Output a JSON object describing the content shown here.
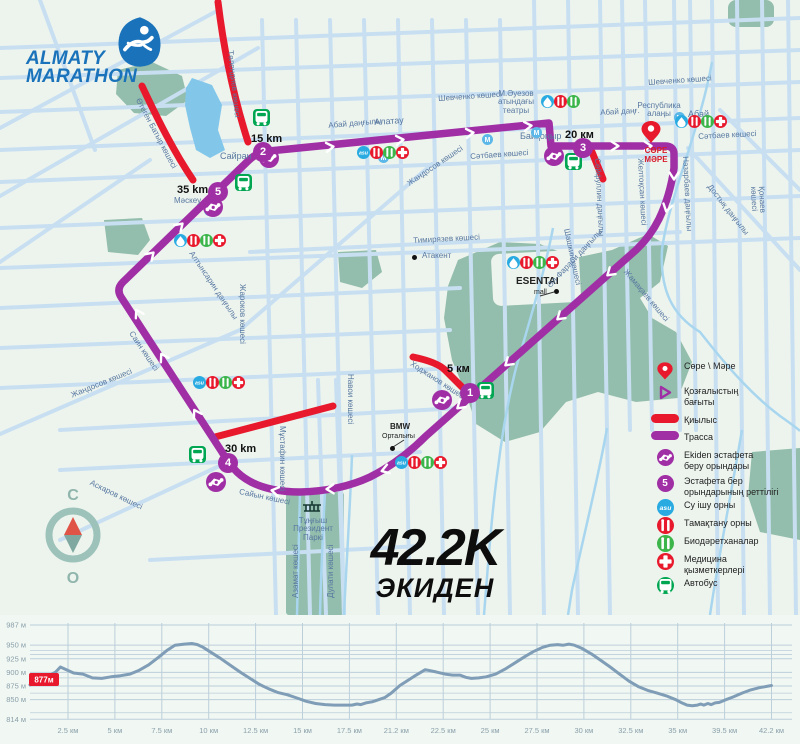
{
  "logo": {
    "line1": "ALMATY",
    "line2": "MARATHON"
  },
  "race_title": {
    "big": "42.2K",
    "sub": "ЭКИДЕН"
  },
  "compass": {
    "north": "С",
    "south": "О"
  },
  "finish": {
    "label": "СӨРЕ\nМӘРЕ"
  },
  "colors": {
    "route": "#a02fa5",
    "crossing": "#e8192c",
    "street": "#c8dff2",
    "park": "#93bdac",
    "water": "#82c7ea",
    "river": "#a9d6ef",
    "bus_green": "#00a651",
    "bio_green": "#3cb54a",
    "asu_blue": "#29abe2",
    "metro_blue": "#5bb7e8",
    "logo_blue": "#1a73ba",
    "chart_line": "#7f9db6",
    "chart_grid": "#bccfdb",
    "badge_red": "#e8192c"
  },
  "markers": [
    {
      "num": "1",
      "x": 470,
      "y": 393,
      "label": "5 км",
      "lx": 447,
      "ly": 363
    },
    {
      "num": "2",
      "x": 263,
      "y": 152,
      "label": "15 km",
      "lx": 251,
      "ly": 133
    },
    {
      "num": "3",
      "x": 583,
      "y": 148,
      "label": "20 км",
      "lx": 565,
      "ly": 129
    },
    {
      "num": "4",
      "x": 228,
      "y": 463,
      "label": "30 km",
      "lx": 225,
      "ly": 443
    },
    {
      "num": "5",
      "x": 218,
      "y": 192,
      "label": "35 km",
      "lx": 177,
      "ly": 184
    }
  ],
  "map_labels": [
    {
      "t": "Шевченко көшесі",
      "x": 438,
      "y": 95,
      "r": -4
    },
    {
      "t": "Шевченко көшесі",
      "x": 648,
      "y": 79,
      "r": -4
    },
    {
      "t": "Абай даңғылы",
      "x": 328,
      "y": 122,
      "r": -5
    },
    {
      "t": "Алатау",
      "x": 374,
      "y": 118,
      "r": -4,
      "s": 9
    },
    {
      "t": "Абай даңғ.",
      "x": 600,
      "y": 109,
      "r": -3
    },
    {
      "t": "Сәтбаев көшесі",
      "x": 470,
      "y": 153,
      "r": -4
    },
    {
      "t": "Сәтбаев көшесі",
      "x": 698,
      "y": 133,
      "r": -3
    },
    {
      "t": "Жандосов көшесі",
      "x": 406,
      "y": 181,
      "r": -34
    },
    {
      "t": "Байқоңыр",
      "x": 520,
      "y": 132,
      "r": 0,
      "s": 9
    },
    {
      "t": "М.Әуезов\nатындағы\nтеатры",
      "x": 486,
      "y": 90,
      "r": 0,
      "align": "center",
      "w": 60
    },
    {
      "t": "Республика\nалаңы",
      "x": 624,
      "y": 102,
      "r": 0,
      "align": "center",
      "w": 70
    },
    {
      "t": "Абай",
      "x": 688,
      "y": 110,
      "r": 0,
      "s": 9
    },
    {
      "t": "Сайран",
      "x": 220,
      "y": 152,
      "r": 0,
      "s": 9
    },
    {
      "t": "Мәскеу",
      "x": 174,
      "y": 197,
      "r": 0
    },
    {
      "t": "Тимирязев көшесі",
      "x": 413,
      "y": 237,
      "r": -3
    },
    {
      "t": "Атакент",
      "x": 422,
      "y": 252,
      "r": 0
    },
    {
      "t": "ESENTAI",
      "x": 516,
      "y": 277,
      "r": 0,
      "s": 10,
      "bold": true,
      "dark": true
    },
    {
      "t": "mall",
      "x": 534,
      "y": 289,
      "r": 0,
      "s": 7,
      "dark": true
    },
    {
      "t": "Әл-Фараби даңғылы",
      "x": 546,
      "y": 284,
      "r": -47
    },
    {
      "t": "Жамақаев көшесі",
      "x": 628,
      "y": 268,
      "r": 50
    },
    {
      "t": "Шашкин көшесі",
      "x": 570,
      "y": 228,
      "r": 78
    },
    {
      "t": "Ходжанов көшесі",
      "x": 413,
      "y": 360,
      "r": 33
    },
    {
      "t": "BMW",
      "x": 390,
      "y": 423,
      "r": 0,
      "bold": true,
      "dark": true
    },
    {
      "t": "Орталығы",
      "x": 382,
      "y": 433,
      "r": 0,
      "s": 7,
      "dark": true
    },
    {
      "t": "Навои көшесі",
      "x": 354,
      "y": 374,
      "r": 90
    },
    {
      "t": "Мұстафин көшесі",
      "x": 286,
      "y": 426,
      "r": 90
    },
    {
      "t": "Саин көшесі",
      "x": 134,
      "y": 330,
      "r": 56
    },
    {
      "t": "Жандосов көшесі",
      "x": 70,
      "y": 392,
      "r": -22
    },
    {
      "t": "Алтынсарин даңғылы",
      "x": 194,
      "y": 250,
      "r": 56
    },
    {
      "t": "Жароков көшесі",
      "x": 246,
      "y": 284,
      "r": 90
    },
    {
      "t": "Аскаров көшесі",
      "x": 92,
      "y": 479,
      "r": 26
    },
    {
      "t": "Сайын көшесі",
      "x": 240,
      "y": 488,
      "r": 12
    },
    {
      "t": "Төлендиев көшесі",
      "x": 234,
      "y": 50,
      "r": 84
    },
    {
      "t": "Өтеген Батыр көшесі",
      "x": 141,
      "y": 97,
      "r": 62
    },
    {
      "t": "Сейфуллин даңғылы",
      "x": 601,
      "y": 158,
      "r": 87
    },
    {
      "t": "Желтоқсан көшесі",
      "x": 644,
      "y": 158,
      "r": 87
    },
    {
      "t": "Назарбаев даңғылы",
      "x": 689,
      "y": 156,
      "r": 87
    },
    {
      "t": "Қонаев көшесі",
      "x": 765,
      "y": 186,
      "r": 87
    },
    {
      "t": "Достық даңғылы",
      "x": 712,
      "y": 183,
      "r": 52
    },
    {
      "t": "Тұңғыш\nПрезидент\nПаркі",
      "x": 288,
      "y": 517,
      "r": 0,
      "align": "center",
      "w": 50
    },
    {
      "t": "Азамат көшесі",
      "x": 292,
      "y": 598,
      "r": -90
    },
    {
      "t": "Дулати көшесі",
      "x": 327,
      "y": 598,
      "r": -90
    }
  ],
  "map_icons": [
    {
      "t": "metro",
      "x": 209,
      "y": 210
    },
    {
      "t": "metro",
      "x": 383,
      "y": 157
    },
    {
      "t": "metro",
      "x": 536,
      "y": 132
    },
    {
      "t": "metro",
      "x": 679,
      "y": 117
    },
    {
      "t": "metro",
      "x": 487,
      "y": 139
    },
    {
      "t": "water",
      "x": 180,
      "y": 240
    },
    {
      "t": "food",
      "x": 193,
      "y": 240
    },
    {
      "t": "bio",
      "x": 206,
      "y": 240
    },
    {
      "t": "medical",
      "x": 219,
      "y": 240
    },
    {
      "t": "asu",
      "x": 363,
      "y": 152
    },
    {
      "t": "food",
      "x": 376,
      "y": 152
    },
    {
      "t": "bio",
      "x": 389,
      "y": 152
    },
    {
      "t": "medical",
      "x": 402,
      "y": 152
    },
    {
      "t": "water",
      "x": 547,
      "y": 101
    },
    {
      "t": "food",
      "x": 560,
      "y": 101
    },
    {
      "t": "bio",
      "x": 573,
      "y": 101
    },
    {
      "t": "water",
      "x": 681,
      "y": 121
    },
    {
      "t": "food",
      "x": 694,
      "y": 121
    },
    {
      "t": "bio",
      "x": 707,
      "y": 121
    },
    {
      "t": "medical",
      "x": 720,
      "y": 121
    },
    {
      "t": "water",
      "x": 513,
      "y": 262
    },
    {
      "t": "food",
      "x": 526,
      "y": 262
    },
    {
      "t": "bio",
      "x": 539,
      "y": 262
    },
    {
      "t": "medical",
      "x": 552,
      "y": 262
    },
    {
      "t": "asu",
      "x": 401,
      "y": 462
    },
    {
      "t": "food",
      "x": 414,
      "y": 462
    },
    {
      "t": "bio",
      "x": 427,
      "y": 462
    },
    {
      "t": "medical",
      "x": 440,
      "y": 462
    },
    {
      "t": "asu",
      "x": 199,
      "y": 382
    },
    {
      "t": "food",
      "x": 212,
      "y": 382
    },
    {
      "t": "bio",
      "x": 225,
      "y": 382
    },
    {
      "t": "medical",
      "x": 238,
      "y": 382
    },
    {
      "t": "bus",
      "x": 261,
      "y": 117
    },
    {
      "t": "bus",
      "x": 243,
      "y": 182
    },
    {
      "t": "bus",
      "x": 573,
      "y": 161
    },
    {
      "t": "bus",
      "x": 485,
      "y": 390
    },
    {
      "t": "bus",
      "x": 197,
      "y": 454
    },
    {
      "t": "handshake",
      "x": 269,
      "y": 158
    },
    {
      "t": "handshake",
      "x": 213,
      "y": 207
    },
    {
      "t": "handshake",
      "x": 554,
      "y": 156
    },
    {
      "t": "handshake",
      "x": 442,
      "y": 400
    },
    {
      "t": "handshake",
      "x": 216,
      "y": 482
    }
  ],
  "poi_dots": [
    {
      "x": 414,
      "y": 257
    },
    {
      "x": 556,
      "y": 291
    },
    {
      "x": 392,
      "y": 448
    }
  ],
  "legend": {
    "items": [
      {
        "icon": "pin",
        "label": "Сөре \\ Мәре",
        "y": 8
      },
      {
        "icon": "direction",
        "label": "Қозғалыстың\nбағыты",
        "y": 33
      },
      {
        "icon": "qiylys",
        "label": "Қиылыс",
        "y": 62
      },
      {
        "icon": "trassa",
        "label": "Трасса",
        "y": 79
      },
      {
        "icon": "handshake",
        "label": "Ekiden эстафета\nберу орындары",
        "y": 97
      },
      {
        "icon": "seq",
        "label": "Эстафета бер\nорындарының реттілігі",
        "y": 123
      },
      {
        "icon": "asu",
        "label": "Су ішу орны",
        "y": 147
      },
      {
        "icon": "food",
        "label": "Тамақтану орны",
        "y": 165
      },
      {
        "icon": "bio",
        "label": "Биодәретханалар",
        "y": 183
      },
      {
        "icon": "medical",
        "label": "Медицина\nқызметкерлері",
        "y": 201
      },
      {
        "icon": "bus",
        "label": "Автобус",
        "y": 225
      }
    ],
    "seq_number": "5"
  },
  "chart_data": {
    "type": "line",
    "title": "Route elevation profile",
    "x_unit": "км",
    "y_unit": "м",
    "ylim": [
      814,
      987
    ],
    "start_badge": "877м",
    "yticks": [
      {
        "v": 987,
        "label": "987 м"
      },
      {
        "v": 950,
        "label": "950 м"
      },
      {
        "v": 925,
        "label": "925 м"
      },
      {
        "v": 900,
        "label": "900 м"
      },
      {
        "v": 875,
        "label": "875 м"
      },
      {
        "v": 850,
        "label": "850 м"
      },
      {
        "v": 814,
        "label": "814 м"
      }
    ],
    "yticks_minor": [
      940,
      933,
      890,
      862,
      826
    ],
    "xticks": [
      {
        "km": 2.5,
        "label": "2.5 км"
      },
      {
        "km": 5,
        "label": "5 км"
      },
      {
        "km": 7.5,
        "label": "7.5 км"
      },
      {
        "km": 10,
        "label": "10 км"
      },
      {
        "km": 12.5,
        "label": "12.5 км"
      },
      {
        "km": 15,
        "label": "15 км"
      },
      {
        "km": 17.5,
        "label": "17.5 км"
      },
      {
        "km": 21.2,
        "label": "21.2 км"
      },
      {
        "km": 22.5,
        "label": "22.5 км"
      },
      {
        "km": 25,
        "label": "25 км"
      },
      {
        "km": 27.5,
        "label": "27.5 км"
      },
      {
        "km": 30,
        "label": "30 км"
      },
      {
        "km": 32.5,
        "label": "32.5 км"
      },
      {
        "km": 35,
        "label": "35 км"
      },
      {
        "km": 39.5,
        "label": "39.5 км"
      },
      {
        "km": 42.2,
        "label": "42.2 км"
      }
    ],
    "series": [
      {
        "name": "elevation",
        "points": [
          [
            0,
            877
          ],
          [
            0.6,
            885
          ],
          [
            1.2,
            893
          ],
          [
            1.7,
            901
          ],
          [
            2,
            910
          ],
          [
            2.3,
            906
          ],
          [
            2.8,
            899
          ],
          [
            3.3,
            897
          ],
          [
            3.8,
            890
          ],
          [
            4.3,
            889
          ],
          [
            4.8,
            892
          ],
          [
            5.3,
            894
          ],
          [
            5.8,
            897
          ],
          [
            6.3,
            904
          ],
          [
            6.8,
            914
          ],
          [
            7.3,
            927
          ],
          [
            7.8,
            941
          ],
          [
            8.2,
            950
          ],
          [
            8.7,
            952
          ],
          [
            9.1,
            953
          ],
          [
            9.4,
            951
          ],
          [
            9.7,
            946
          ],
          [
            10.2,
            935
          ],
          [
            10.7,
            924
          ],
          [
            11.2,
            912
          ],
          [
            11.7,
            900
          ],
          [
            12.2,
            889
          ],
          [
            12.7,
            878
          ],
          [
            13.2,
            870
          ],
          [
            13.7,
            863
          ],
          [
            14.2,
            859
          ],
          [
            14.7,
            853
          ],
          [
            15.2,
            847
          ],
          [
            15.7,
            843
          ],
          [
            16.2,
            841
          ],
          [
            16.7,
            840
          ],
          [
            17.2,
            840
          ],
          [
            17.7,
            840
          ],
          [
            18.1,
            842
          ],
          [
            18.4,
            841
          ],
          [
            18.8,
            844
          ],
          [
            19.3,
            846
          ],
          [
            19.8,
            850
          ],
          [
            20.3,
            854
          ],
          [
            20.8,
            862
          ],
          [
            21.3,
            876
          ],
          [
            21.7,
            893
          ],
          [
            22,
            905
          ],
          [
            22.3,
            901
          ],
          [
            22.6,
            897
          ],
          [
            23,
            895
          ],
          [
            23.4,
            895
          ],
          [
            23.7,
            891
          ],
          [
            24,
            889
          ],
          [
            24.4,
            890
          ],
          [
            24.8,
            892
          ],
          [
            25.3,
            897
          ],
          [
            25.8,
            906
          ],
          [
            26.3,
            917
          ],
          [
            26.8,
            928
          ],
          [
            27.3,
            938
          ],
          [
            27.8,
            946
          ],
          [
            28.2,
            950
          ],
          [
            28.6,
            951
          ],
          [
            28.9,
            950
          ],
          [
            29.2,
            952
          ],
          [
            29.5,
            950
          ],
          [
            29.9,
            944
          ],
          [
            30.4,
            934
          ],
          [
            30.9,
            922
          ],
          [
            31.4,
            910
          ],
          [
            31.9,
            897
          ],
          [
            32.4,
            884
          ],
          [
            32.9,
            874
          ],
          [
            33.4,
            867
          ],
          [
            33.9,
            862
          ],
          [
            34.4,
            857
          ],
          [
            34.9,
            850
          ],
          [
            35.4,
            844
          ],
          [
            35.9,
            840
          ],
          [
            36.4,
            839
          ],
          [
            36.9,
            840
          ],
          [
            37.2,
            842
          ],
          [
            37.5,
            840
          ],
          [
            37.9,
            843
          ],
          [
            38.2,
            841
          ],
          [
            38.6,
            844
          ],
          [
            39,
            845
          ],
          [
            39.5,
            849
          ],
          [
            40,
            855
          ],
          [
            40.5,
            862
          ],
          [
            41,
            868
          ],
          [
            41.5,
            872
          ],
          [
            42.2,
            876
          ]
        ]
      }
    ]
  }
}
